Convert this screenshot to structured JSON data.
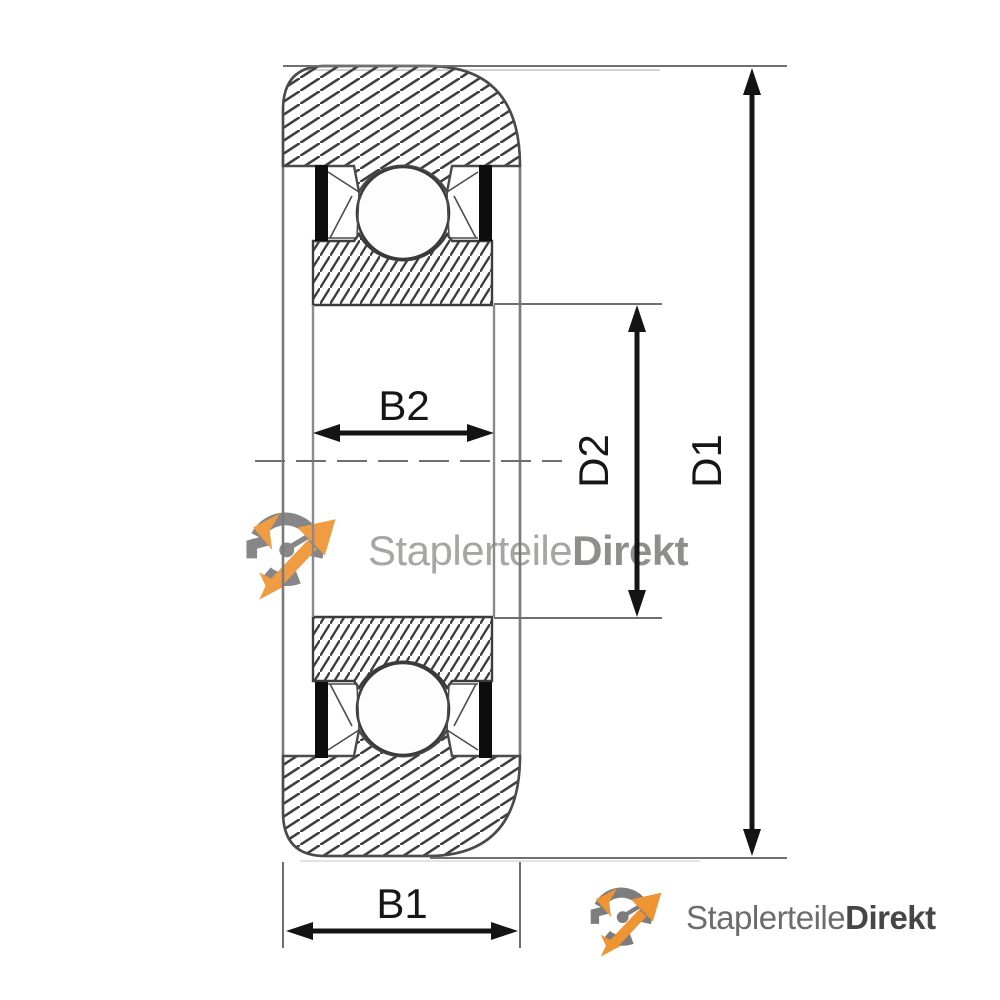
{
  "drawing": {
    "dimensions": {
      "b1": {
        "label": "B1"
      },
      "b2": {
        "label": "B2"
      },
      "d1": {
        "label": "D1"
      },
      "d2": {
        "label": "D2"
      }
    }
  },
  "watermark": {
    "brand_regular": "Staplerteile",
    "brand_bold": "Direkt"
  },
  "footer_logo": {
    "brand_regular": "Staplerteile",
    "brand_bold": "Direkt"
  },
  "colors": {
    "accent_orange": "#EF9433",
    "logo_gray": "#7D7D7D",
    "watermark_text": "#A6A6A4",
    "watermark_text_bold": "#8E8E8C",
    "footer_text": "#6C6C6C",
    "footer_text_bold": "#464646",
    "dimension_line": "#141414",
    "extension_line": "#6F6F6F",
    "drawing_outline": "#7A7A7A",
    "hatch_line": "#3F3F3F",
    "seal_black": "#0D0D0D"
  }
}
